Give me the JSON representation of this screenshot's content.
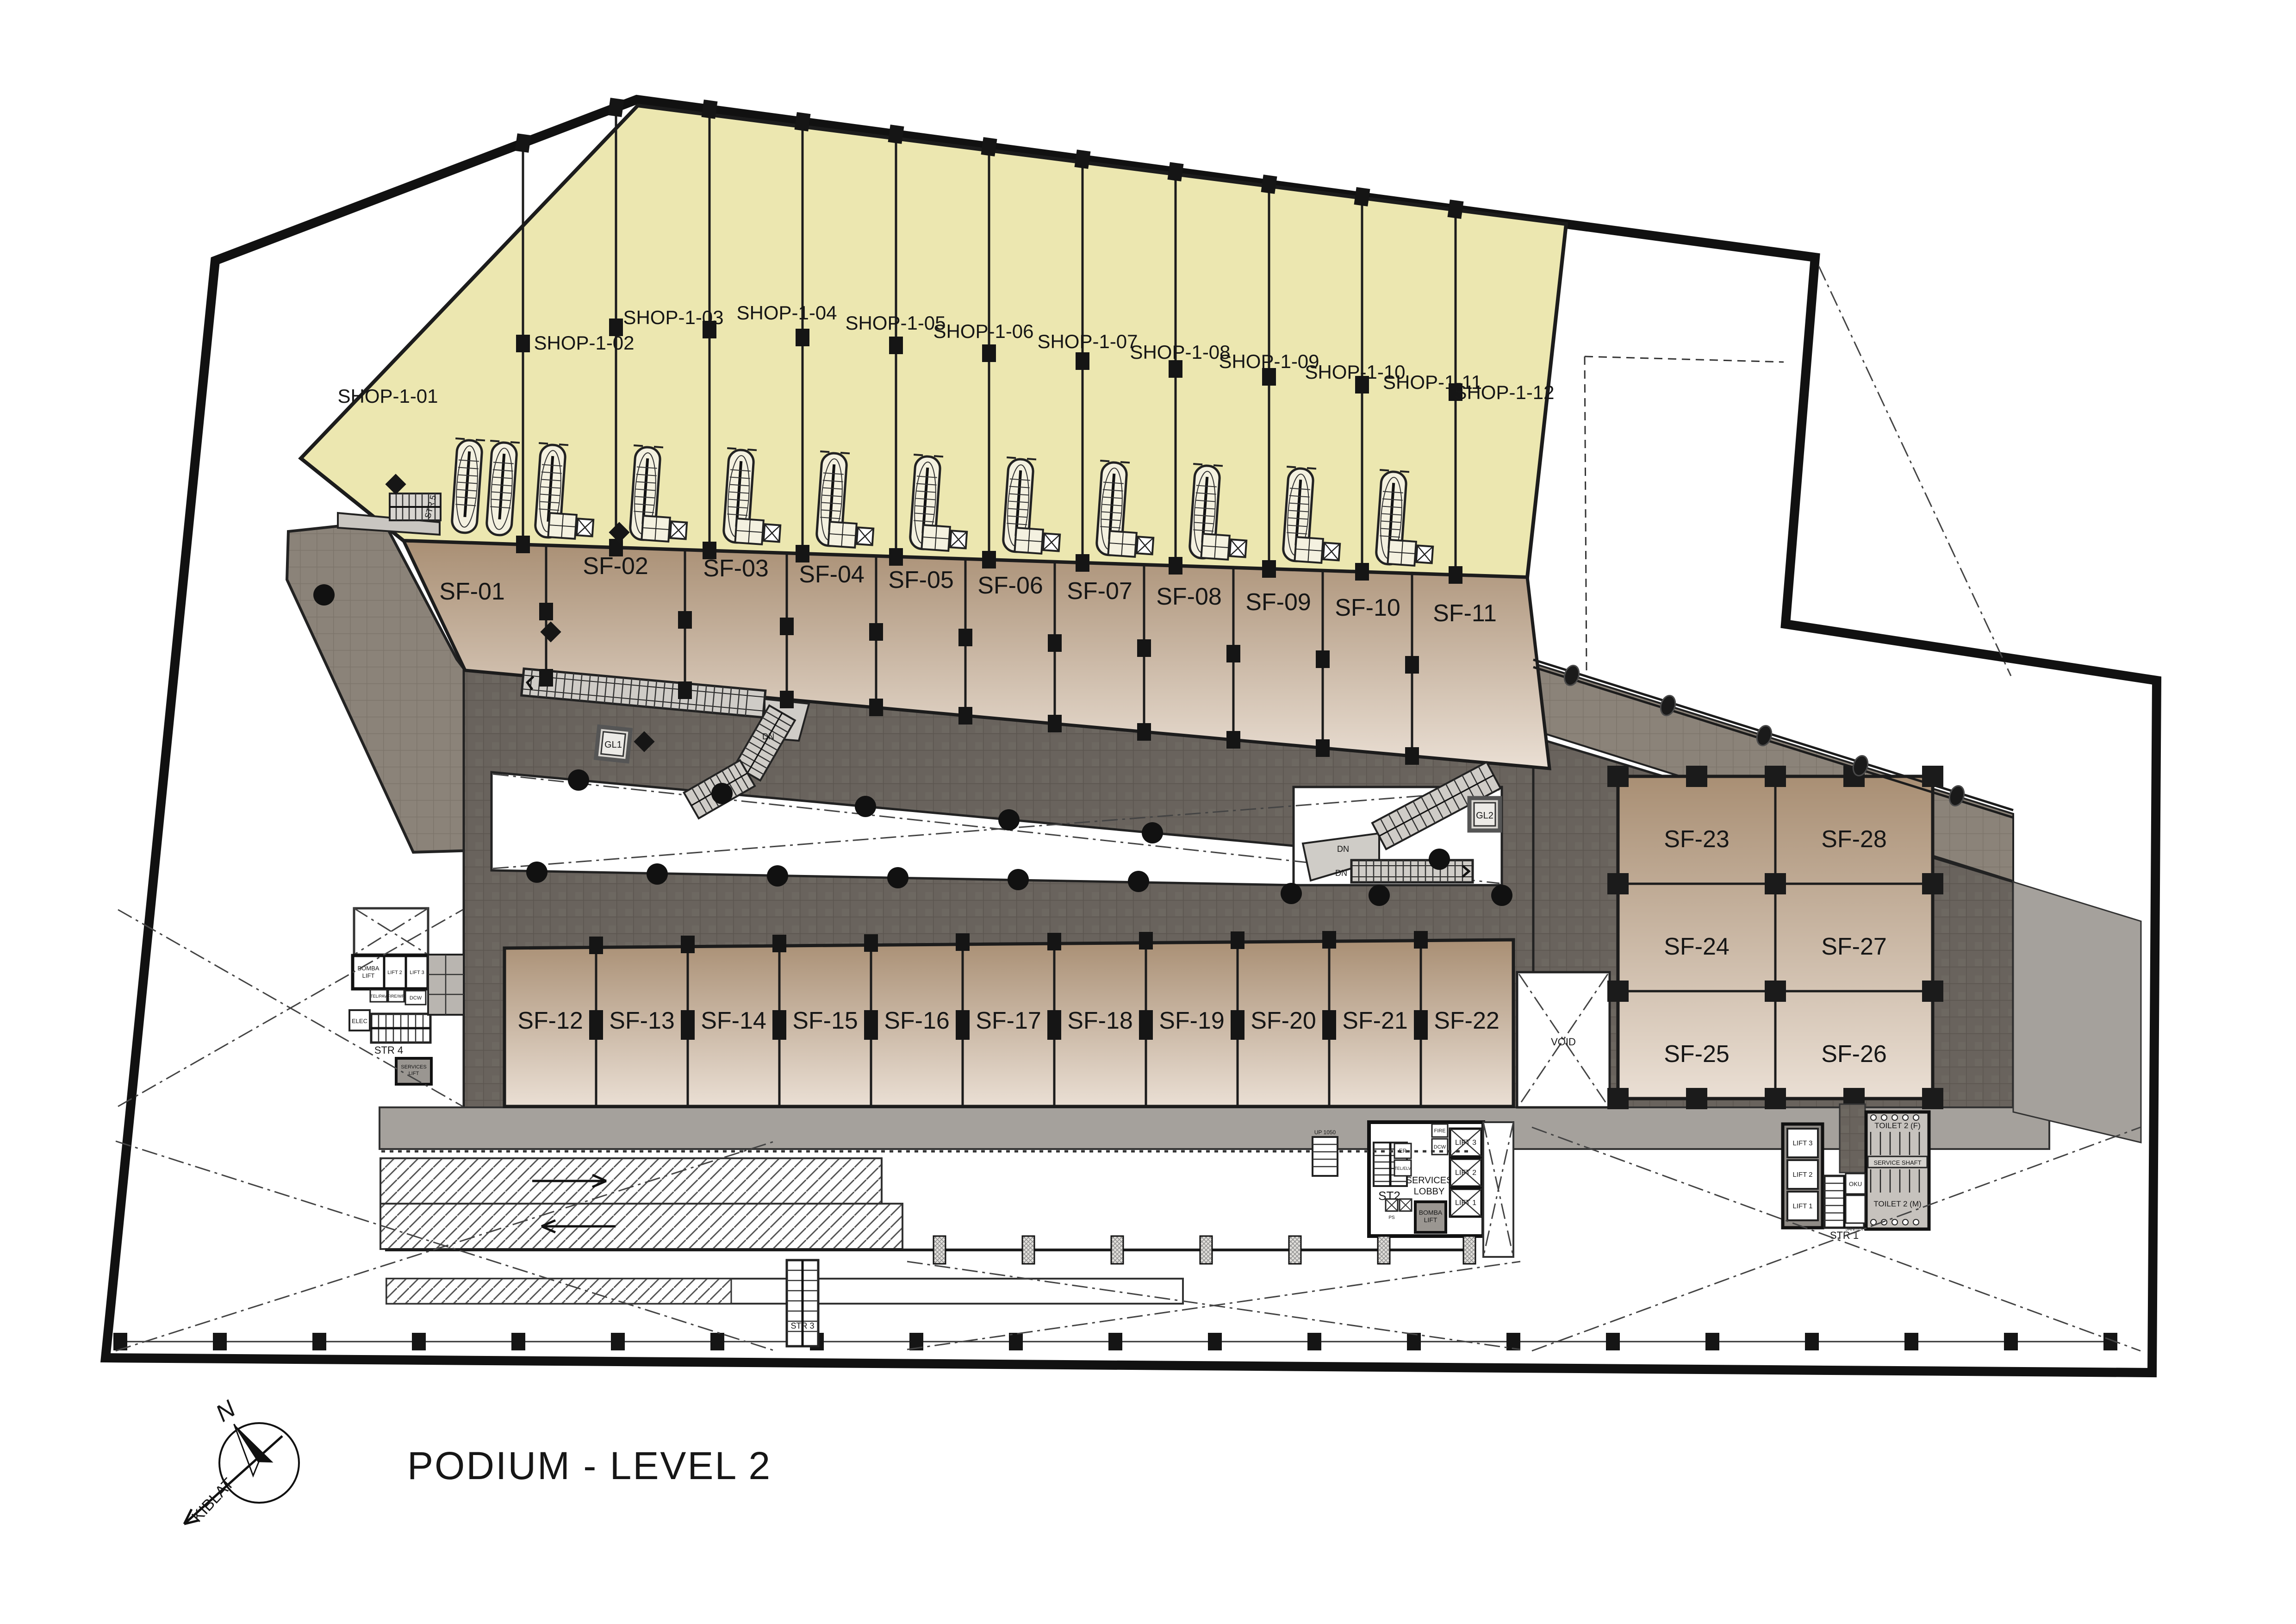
{
  "title": "PODIUM - LEVEL 2",
  "compass": {
    "north": "N",
    "qibla": "KIBLAT"
  },
  "units": {
    "shops": [
      "SHOP-1-01",
      "SHOP-1-02",
      "SHOP-1-03",
      "SHOP-1-04",
      "SHOP-1-05",
      "SHOP-1-06",
      "SHOP-1-07",
      "SHOP-1-08",
      "SHOP-1-09",
      "SHOP-1-10",
      "SHOP-1-11",
      "SHOP-1-12"
    ],
    "sf_upper": [
      "SF-01",
      "SF-02",
      "SF-03",
      "SF-04",
      "SF-05",
      "SF-06",
      "SF-07",
      "SF-08",
      "SF-09",
      "SF-10",
      "SF-11"
    ],
    "sf_lower": [
      "SF-12",
      "SF-13",
      "SF-14",
      "SF-15",
      "SF-16",
      "SF-17",
      "SF-18",
      "SF-19",
      "SF-20",
      "SF-21",
      "SF-22"
    ],
    "sf_block": [
      "SF-23",
      "SF-24",
      "SF-25",
      "SF-26",
      "SF-27",
      "SF-28"
    ]
  },
  "cores": {
    "left": {
      "bomba_1": "BOMBA",
      "bomba_2": "LIFT",
      "lift2": "LIFT 2",
      "lift3": "LIFT 3",
      "tel": "TEL/PAV",
      "fire": "FIRE/WR",
      "dcw": "DCW",
      "elec": "ELEC",
      "str4": "STR 4",
      "services_lift_1": "SERVICES",
      "services_lift_2": "LIFT"
    },
    "center": {
      "st2": "ST2",
      "services_lobby_1": "SERVICES",
      "services_lobby_2": "LOBBY",
      "bomba_1": "BOMBA",
      "bomba_2": "LIFT",
      "lift1": "LIFT 1",
      "lift2": "LIFT 2",
      "lift3": "LIFT 3",
      "er": "ER",
      "tel": "TEL/ELV",
      "fire": "FIRE",
      "dcw": "DCW",
      "ps": "PS"
    },
    "right": {
      "lift1": "LIFT 1",
      "lift2": "LIFT 2",
      "lift3": "LIFT 3",
      "str1": "STR 1",
      "toilet_f": "TOILET 2 (F)",
      "service_shaft": "SERVICE SHAFT",
      "toilet_m": "TOILET 2 (M)",
      "oku": "OKU",
      "janitor": "JANITOR"
    }
  },
  "stairs": {
    "str5": "STR 5",
    "str3": "STR 3"
  },
  "lifts": {
    "gl1": "GL1",
    "gl2": "GL2"
  },
  "annotations": {
    "void": "VOID",
    "dn": "DN",
    "up": "UP 1050"
  },
  "colors": {
    "shop_fill": "#ece7b0",
    "sf_dark": "#a98f74",
    "sf_light": "#eadfd4",
    "corridor_tile": "#69635d",
    "terrace_tile": "#8b8379",
    "walkway": "#a5a19c",
    "boundary": "#111111"
  }
}
